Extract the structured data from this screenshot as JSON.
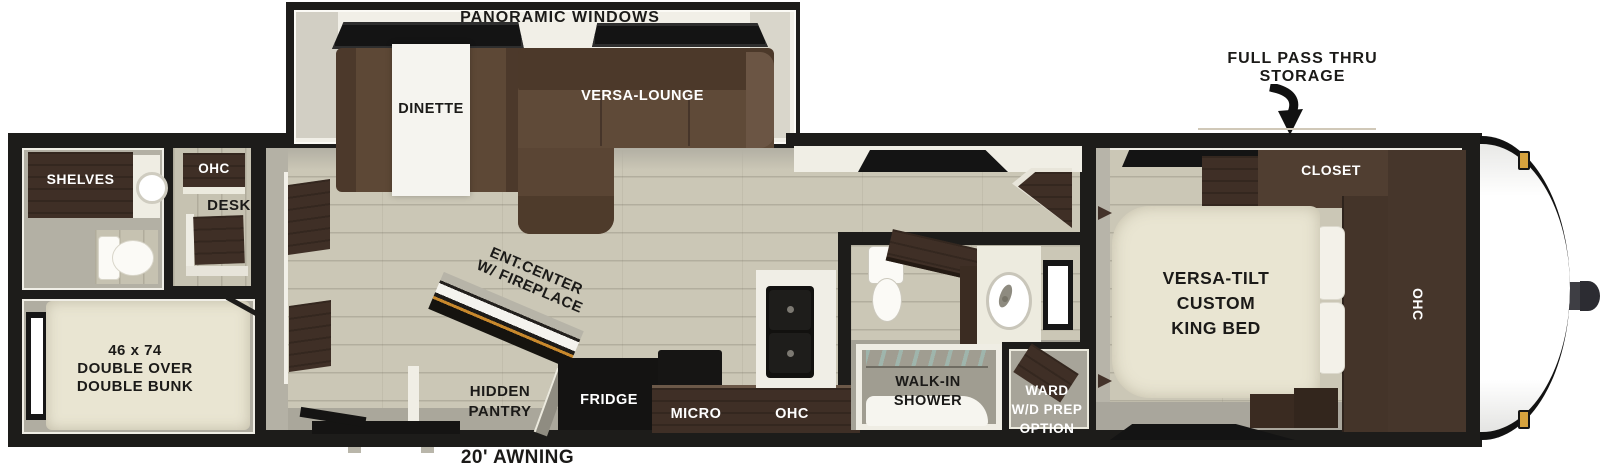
{
  "exterior": {
    "panoramic_windows": "PANORAMIC WINDOWS",
    "full_pass_thru": {
      "line1": "FULL PASS THRU",
      "line2": "STORAGE"
    },
    "awning": "20' AWNING"
  },
  "slide_out": {
    "dinette": "DINETTE",
    "versa_lounge": "VERSA-LOUNGE"
  },
  "rear": {
    "shelves": "SHELVES",
    "ohc": "OHC",
    "desk": "DESK",
    "bunk": {
      "line1": "46 x 74",
      "line2": "DOUBLE OVER",
      "line3": "DOUBLE BUNK"
    }
  },
  "living": {
    "ent_center": {
      "line1": "ENT.CENTER",
      "line2": "W/ FIREPLACE"
    },
    "hidden_pantry": {
      "line1": "HIDDEN",
      "line2": "PANTRY"
    }
  },
  "kitchen": {
    "fridge": "FRIDGE",
    "micro": "MICRO",
    "ohc": "OHC"
  },
  "bathroom": {
    "shower": {
      "line1": "WALK-IN",
      "line2": "SHOWER"
    },
    "ward": {
      "line1": "WARD",
      "line2": "W/D PREP",
      "line3": "OPTION"
    }
  },
  "bedroom": {
    "bed": {
      "line1": "VERSA-TILT",
      "line2": "CUSTOM",
      "line3": "KING BED"
    },
    "closet": "CLOSET",
    "ohc": "OHC"
  },
  "colors": {
    "wall": "#1d1c1a",
    "floor_wood": "#cbc7b6",
    "floor_gray": "#adaa9e",
    "cabinet_dark": "#3f2f26",
    "sofa": "#5d4836",
    "bed_beige": "#e9e5d2",
    "fireplace_accent": "#c8882c",
    "marker_light": "#d7a33e"
  }
}
